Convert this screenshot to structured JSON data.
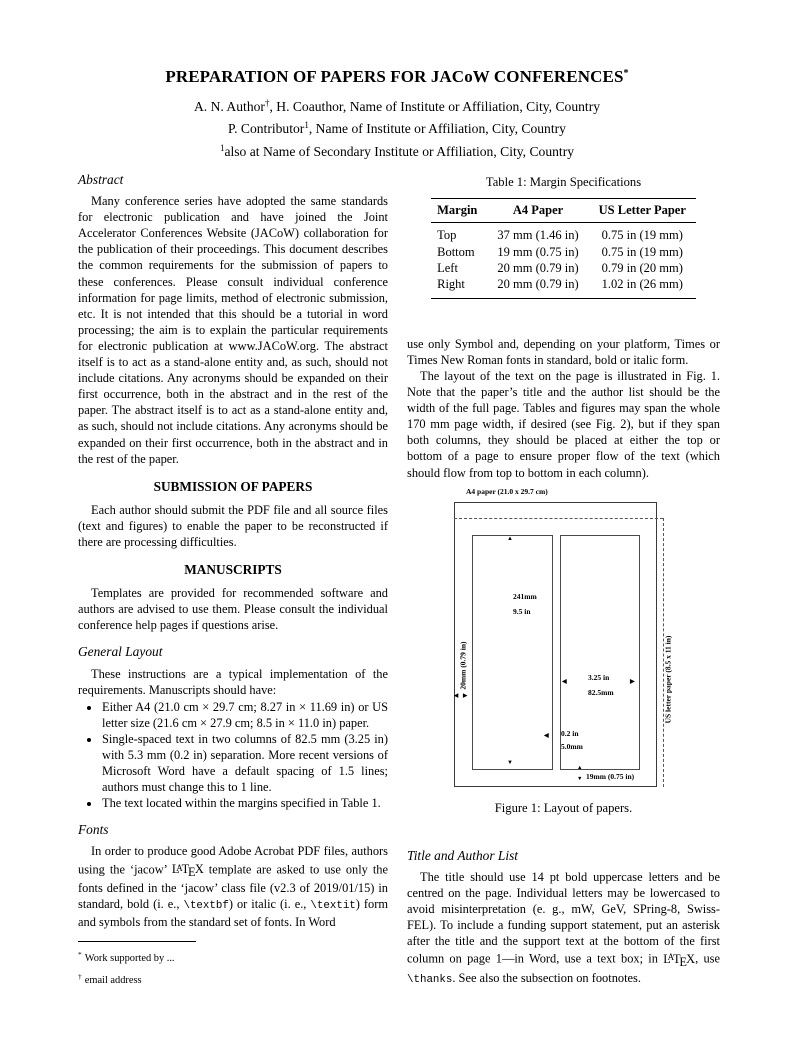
{
  "colors": {
    "background": "#ffffff",
    "text": "#000000"
  },
  "latex": {
    "L": "L",
    "A": "A",
    "T": "T",
    "E": "E",
    "X": "X"
  },
  "icons": {
    "arrow_up": "▲",
    "arrow_down": "▼",
    "arrow_left": "◀",
    "arrow_right": "▶"
  },
  "header": {
    "title": "PREPARATION OF PAPERS FOR JACoW CONFERENCES",
    "title_marker": "*",
    "authors": [
      {
        "pre": "A. N. Author",
        "sup": "†",
        "post": ", H. Coauthor, Name of Institute or Affiliation, City, Country"
      },
      {
        "pre": "P. Contributor",
        "sup": "1",
        "post": ", Name of Institute or Affiliation, City, Country"
      },
      {
        "pre": "",
        "sup": "1",
        "post": "also at Name of Secondary Institute or Affiliation, City, Country"
      }
    ]
  },
  "left": {
    "abstract_heading": "Abstract",
    "abstract_text": "Many conference series have adopted the same standards for electronic publication and have joined the Joint Accelerator Conferences Website (JACoW) collaboration for the publication of their proceedings. This document describes the common requirements for the submission of papers to these conferences. Please consult individual conference information for page limits, method of electronic submission, etc. It is not intended that this should be a tutorial in word processing; the aim is to explain the particular requirements for electronic publication at www.JACoW.org. The abstract itself is to act as a stand-alone entity and, as such, should not include citations. Any acronyms should be expanded on their first occurrence, both in the abstract and in the rest of the paper. The abstract itself is to act as a stand-alone entity and, as such, should not include citations. Any acronyms should be expanded on their first occurrence, both in the abstract and in the rest of the paper.",
    "submission_heading": "SUBMISSION OF PAPERS",
    "submission_text": "Each author should submit the PDF file and all source files (text and figures) to enable the paper to be reconstructed if there are processing difficulties.",
    "manuscripts_heading": "MANUSCRIPTS",
    "manuscripts_text": "Templates are provided for recommended software and authors are advised to use them. Please consult the individual conference help pages if questions arise.",
    "general_layout_heading": "General Layout",
    "general_layout_intro": "These instructions are a typical implementation of the requirements. Manuscripts should have:",
    "bullets": [
      "Either A4 (21.0 cm × 29.7 cm; 8.27 in × 11.69 in) or US letter size (21.6 cm × 27.9 cm; 8.5 in × 11.0 in) paper.",
      "Single-spaced text in two columns of 82.5 mm (3.25 in) with 5.3 mm (0.2 in) separation. More recent versions of Microsoft Word have a default spacing of 1.5 lines; authors must change this to 1 line.",
      "The text located within the margins specified in Table 1."
    ],
    "fonts_heading": "Fonts",
    "fonts": {
      "p1": "In order to produce good Adobe Acrobat PDF files, authors using the ‘jacow’ ",
      "p2": " template are asked to use only the fonts defined in the ‘jacow’ class file (v2.3 of 2019/01/15) in standard, bold (i. e., ",
      "mono_bf": "\\textbf",
      "p3": ") or italic (i. e., ",
      "mono_it": "\\textit",
      "p4": ") form and symbols from the standard set of fonts. In Word"
    }
  },
  "right": {
    "table": {
      "caption": "Table 1: Margin Specifications",
      "headers": [
        "Margin",
        "A4 Paper",
        "US Letter Paper"
      ],
      "rows": [
        [
          "Top",
          "37 mm (1.46 in)",
          "0.75 in (19 mm)"
        ],
        [
          "Bottom",
          "19 mm (0.75 in)",
          "0.75 in (19 mm)"
        ],
        [
          "Left",
          "20 mm (0.79 in)",
          "0.79 in (20 mm)"
        ],
        [
          "Right",
          "20 mm (0.79 in)",
          "1.02 in (26 mm)"
        ]
      ]
    },
    "para1": "use only Symbol and, depending on your platform, Times or Times New Roman fonts in standard, bold or italic form.",
    "para2": "The layout of the text on the page is illustrated in Fig. 1. Note that the paper’s title and the author list should be the width of the full page. Tables and figures may span the whole 170 mm page width, if desired (see Fig. 2), but if they span both columns, they should be placed at either the top or bottom of a page to ensure proper flow of the text (which should flow from top to bottom in each column).",
    "figure": {
      "a4_label": "A4 paper (21.0 x 29.7 cm)",
      "col_height_line1": "241mm",
      "col_height_line2": "9.5 in",
      "left_margin_label": "20mm (0.79 in)",
      "col_width_line1": "3.25 in",
      "col_width_line2": "82.5mm",
      "gap_line1": "0.2 in",
      "gap_line2": "5.0mm",
      "bottom_margin_label": "19mm (0.75 in)",
      "us_letter_label": "US letter paper (8.5 x 11 in)",
      "caption": "Figure 1: Layout of papers."
    },
    "title_author_heading": "Title and Author List",
    "title_author": {
      "p1": "The title should use 14 pt bold uppercase letters and be centred on the page. Individual letters may be lowercased to avoid misinterpretation (e. g., mW, GeV, SPring-8, Swiss-FEL). To include a funding support statement, put an asterisk after the title and the support text at the bottom of the first column on page 1—in Word, use a text box; in ",
      "p2": ", use ",
      "mono": "\\thanks",
      "p3": ". See also the subsection on footnotes."
    }
  },
  "footnotes": [
    {
      "sup": "*",
      "text": "Work supported by ..."
    },
    {
      "sup": "†",
      "text": "email address"
    }
  ]
}
